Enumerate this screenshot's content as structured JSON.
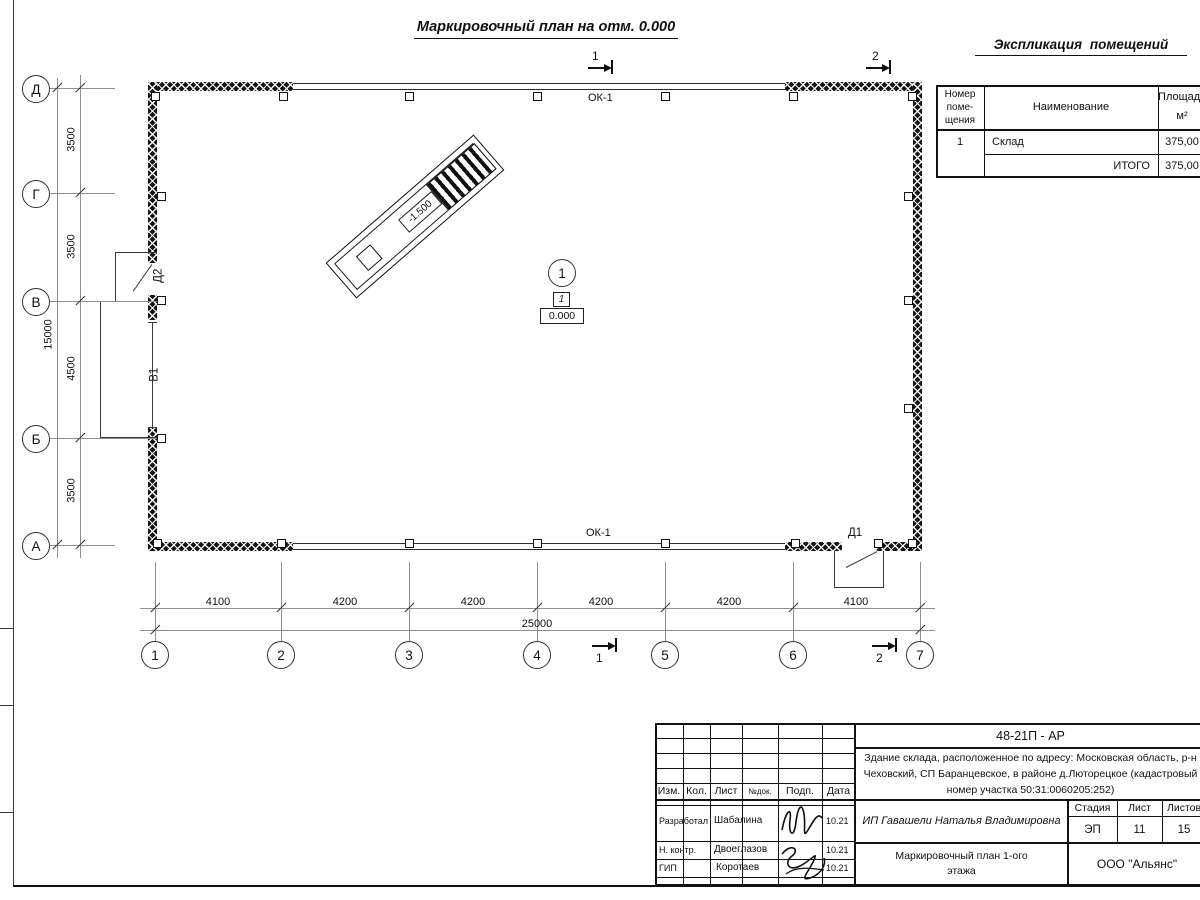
{
  "plan_title": "Маркировочный план на отм. 0.000",
  "explication": {
    "title": "Экспликация  помещений",
    "col_num": "Номер\nпоме-\nщения",
    "col_name": "Наименование",
    "col_area": "Площадь\nм²",
    "rows": [
      {
        "num": "1",
        "name": "Склад",
        "area": "375,00"
      }
    ],
    "total_label": "ИТОГО",
    "total_value": "375,00"
  },
  "axes": {
    "rows": [
      "Д",
      "Г",
      "В",
      "Б",
      "А"
    ],
    "cols": [
      "1",
      "2",
      "3",
      "4",
      "5",
      "6",
      "7"
    ]
  },
  "dims": {
    "left": [
      "3500",
      "3500",
      "4500",
      "3500"
    ],
    "left_total": "15000",
    "bottom": [
      "4100",
      "4200",
      "4200",
      "4200",
      "4200",
      "4100"
    ],
    "bottom_total": "25000"
  },
  "marks": {
    "window_top": "ОК-1",
    "window_bottom": "ОК-1",
    "door1": "Д1",
    "door2": "Д2",
    "gate": "В1",
    "ramp_level": "-1.500",
    "room_axis": "1",
    "room_number": "1",
    "room_level": "0.000",
    "section1": "1",
    "section2": "2"
  },
  "titleblock": {
    "doc_code": "48-21П - АР",
    "address": "Здание склада, расположенное по адресу: Московская область, р-н\nЧеховский, СП Баранцевское, в районе д.Люторецкое  (кадастровый\nномер участка 50:31:0060205:252)",
    "col_izm": "Изм.",
    "col_kol": "Кол.",
    "col_list": "Лист",
    "col_ndok": "№док.",
    "col_podp": "Подп.",
    "col_data": "Дата",
    "row1_role": "Разработал",
    "row1_name": "Шабалина",
    "row1_date": "10.21",
    "row2_role": "Н. контр.",
    "row2_name": "Двоеглазов",
    "row2_date": "10.21",
    "row3_role": "ГИП",
    "row3_name": "Коротаев",
    "row3_date": "10.21",
    "client": "ИП Гавашели Наталья Владимировна",
    "stage_label": "Стадия",
    "sheet_label": "Лист",
    "sheets_label": "Листов",
    "stage": "ЭП",
    "sheet_num": "11",
    "sheets_total": "15",
    "doc_name": "Маркировочный план 1-ого\nэтажа",
    "org": "ООО \"Альянс\""
  }
}
